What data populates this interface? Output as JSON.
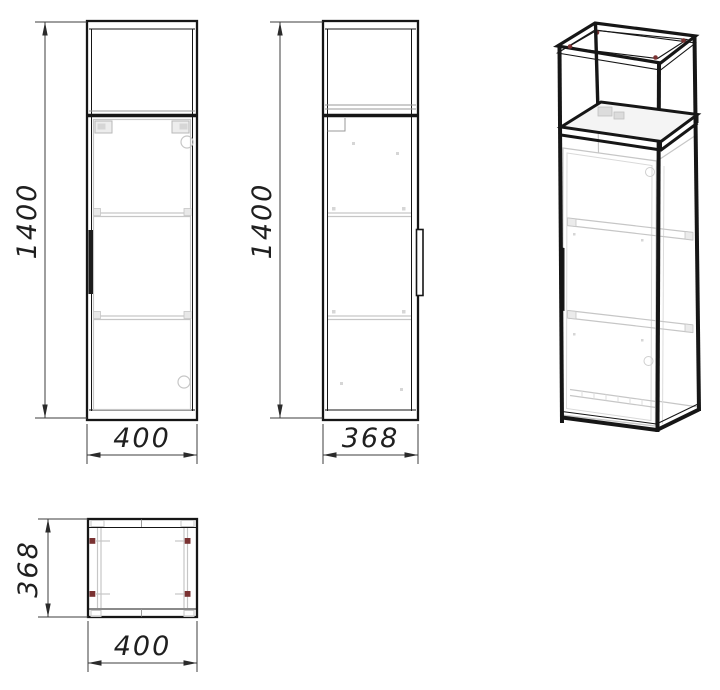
{
  "drawing": {
    "background": "#ffffff",
    "line_color": "#161616",
    "light_line_color": "#c6c6c6",
    "accent_color": "#7a3232",
    "views": {
      "front": {
        "height": "1400",
        "width": "400"
      },
      "side": {
        "height": "1400",
        "width": "368"
      },
      "top": {
        "depth": "368",
        "width": "400"
      }
    }
  }
}
